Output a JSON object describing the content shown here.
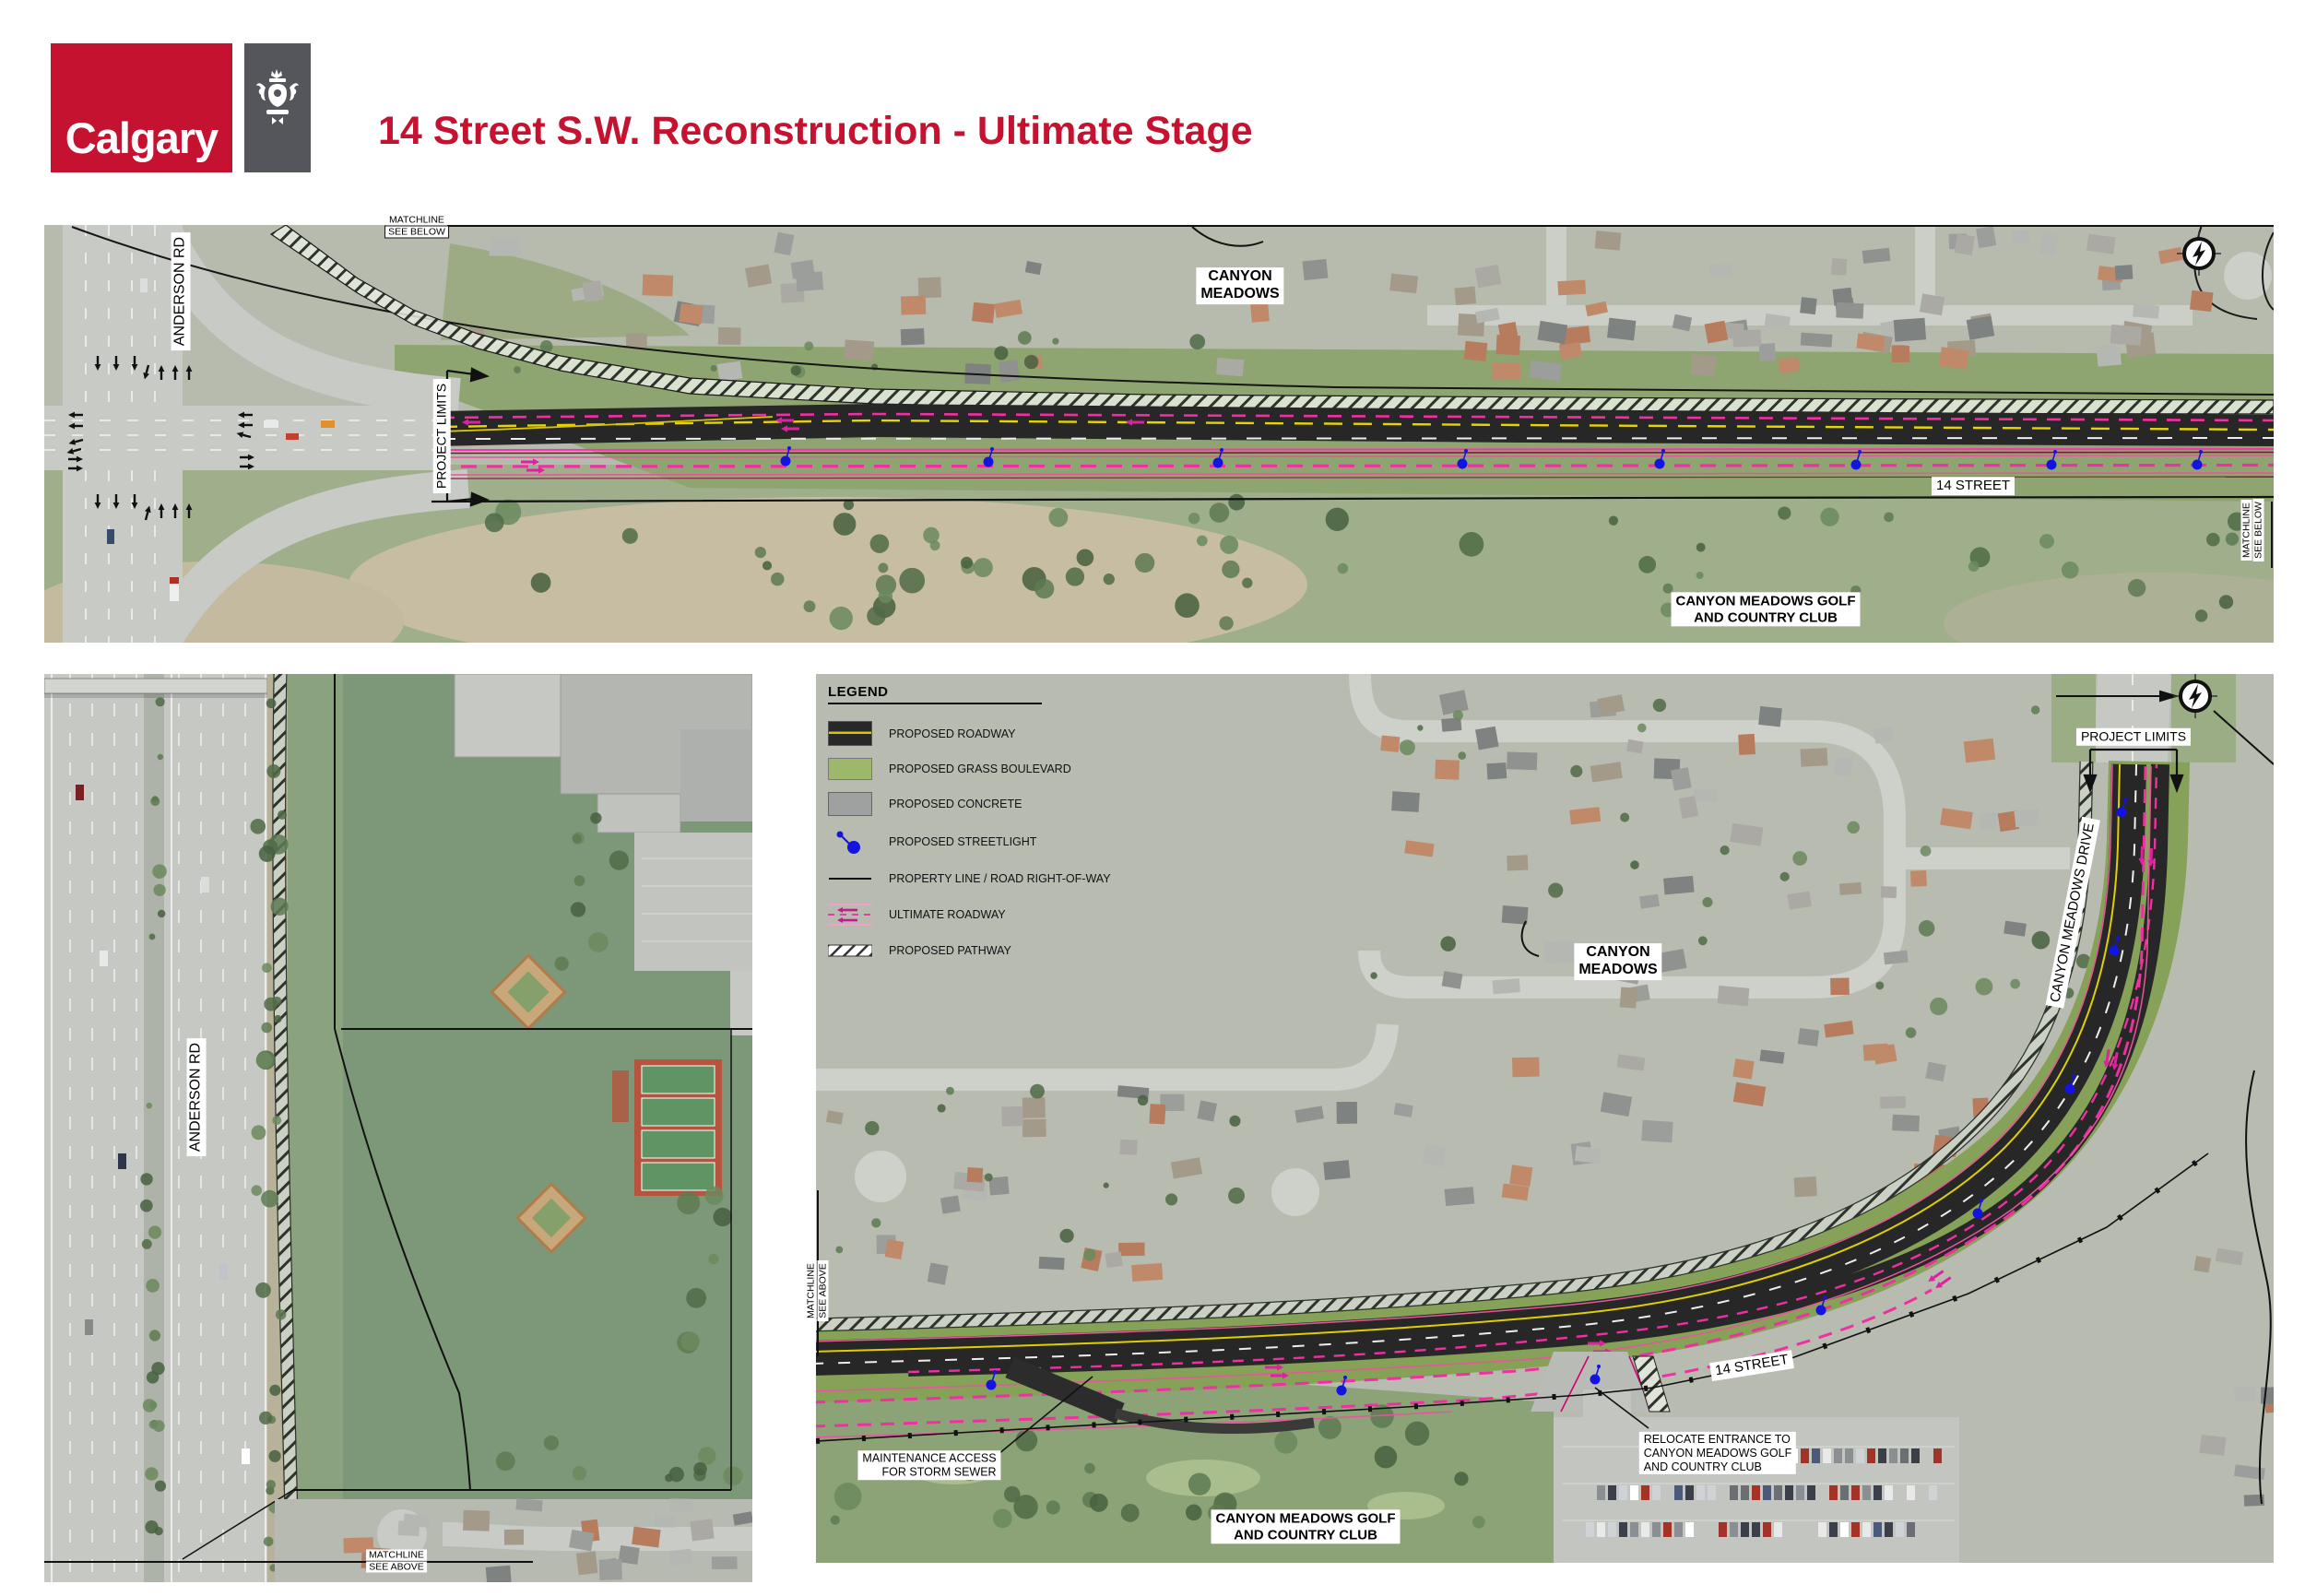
{
  "header": {
    "logo_text": "Calgary",
    "title": "14 Street S.W. Reconstruction - Ultimate Stage"
  },
  "legend": {
    "title": "LEGEND",
    "items": [
      {
        "key": "roadway",
        "label": "PROPOSED ROADWAY"
      },
      {
        "key": "grass",
        "label": "PROPOSED GRASS BOULEVARD"
      },
      {
        "key": "concrete",
        "label": "PROPOSED CONCRETE"
      },
      {
        "key": "streetlight",
        "label": "PROPOSED STREETLIGHT"
      },
      {
        "key": "property",
        "label": "PROPERTY LINE / ROAD RIGHT-OF-WAY"
      },
      {
        "key": "ultimate",
        "label": "ULTIMATE ROADWAY"
      },
      {
        "key": "pathway",
        "label": "PROPOSED PATHWAY"
      }
    ]
  },
  "map_top": {
    "matchline_top": {
      "line1": "MATCHLINE",
      "line2": "SEE BELOW"
    },
    "anderson_rd": "ANDERSON RD",
    "project_limits": "PROJECT LIMITS",
    "canyon_meadows": {
      "line1": "CANYON",
      "line2": "MEADOWS"
    },
    "street_14": "14 STREET",
    "golf_club": {
      "line1": "CANYON MEADOWS GOLF",
      "line2": "AND COUNTRY CLUB"
    },
    "matchline_right": {
      "line1": "MATCHLINE",
      "line2": "SEE BELOW"
    }
  },
  "map_bottom_left": {
    "anderson_rd": "ANDERSON RD",
    "matchline_bottom": {
      "line1": "MATCHLINE",
      "line2": "SEE ABOVE"
    }
  },
  "map_bottom_right": {
    "matchline_left": {
      "line1": "MATCHLINE",
      "line2": "SEE ABOVE"
    },
    "project_limits": "PROJECT LIMITS",
    "canyon_meadows_drive": "CANYON MEADOWS DRIVE",
    "canyon_meadows": {
      "line1": "CANYON",
      "line2": "MEADOWS"
    },
    "street_14": "14 STREET",
    "maintenance_access": {
      "line1": "MAINTENANCE ACCESS",
      "line2": "FOR STORM SEWER"
    },
    "relocate_entrance": {
      "line1": "RELOCATE ENTRANCE TO",
      "line2": "CANYON MEADOWS GOLF",
      "line3": "AND COUNTRY CLUB"
    },
    "golf_club": {
      "line1": "CANYON MEADOWS GOLF",
      "line2": "AND COUNTRY CLUB"
    }
  },
  "colors": {
    "calgary_red": "#C51230",
    "logo_slate": "#54565B",
    "proposed_roadway": "#272727",
    "grass_boulevard": "#86A158",
    "concrete": "#9FA1A0",
    "streetlight_blue": "#1414E0",
    "ultimate_magenta": "#EE2F9E",
    "centerline_yellow": "#E8D400"
  }
}
